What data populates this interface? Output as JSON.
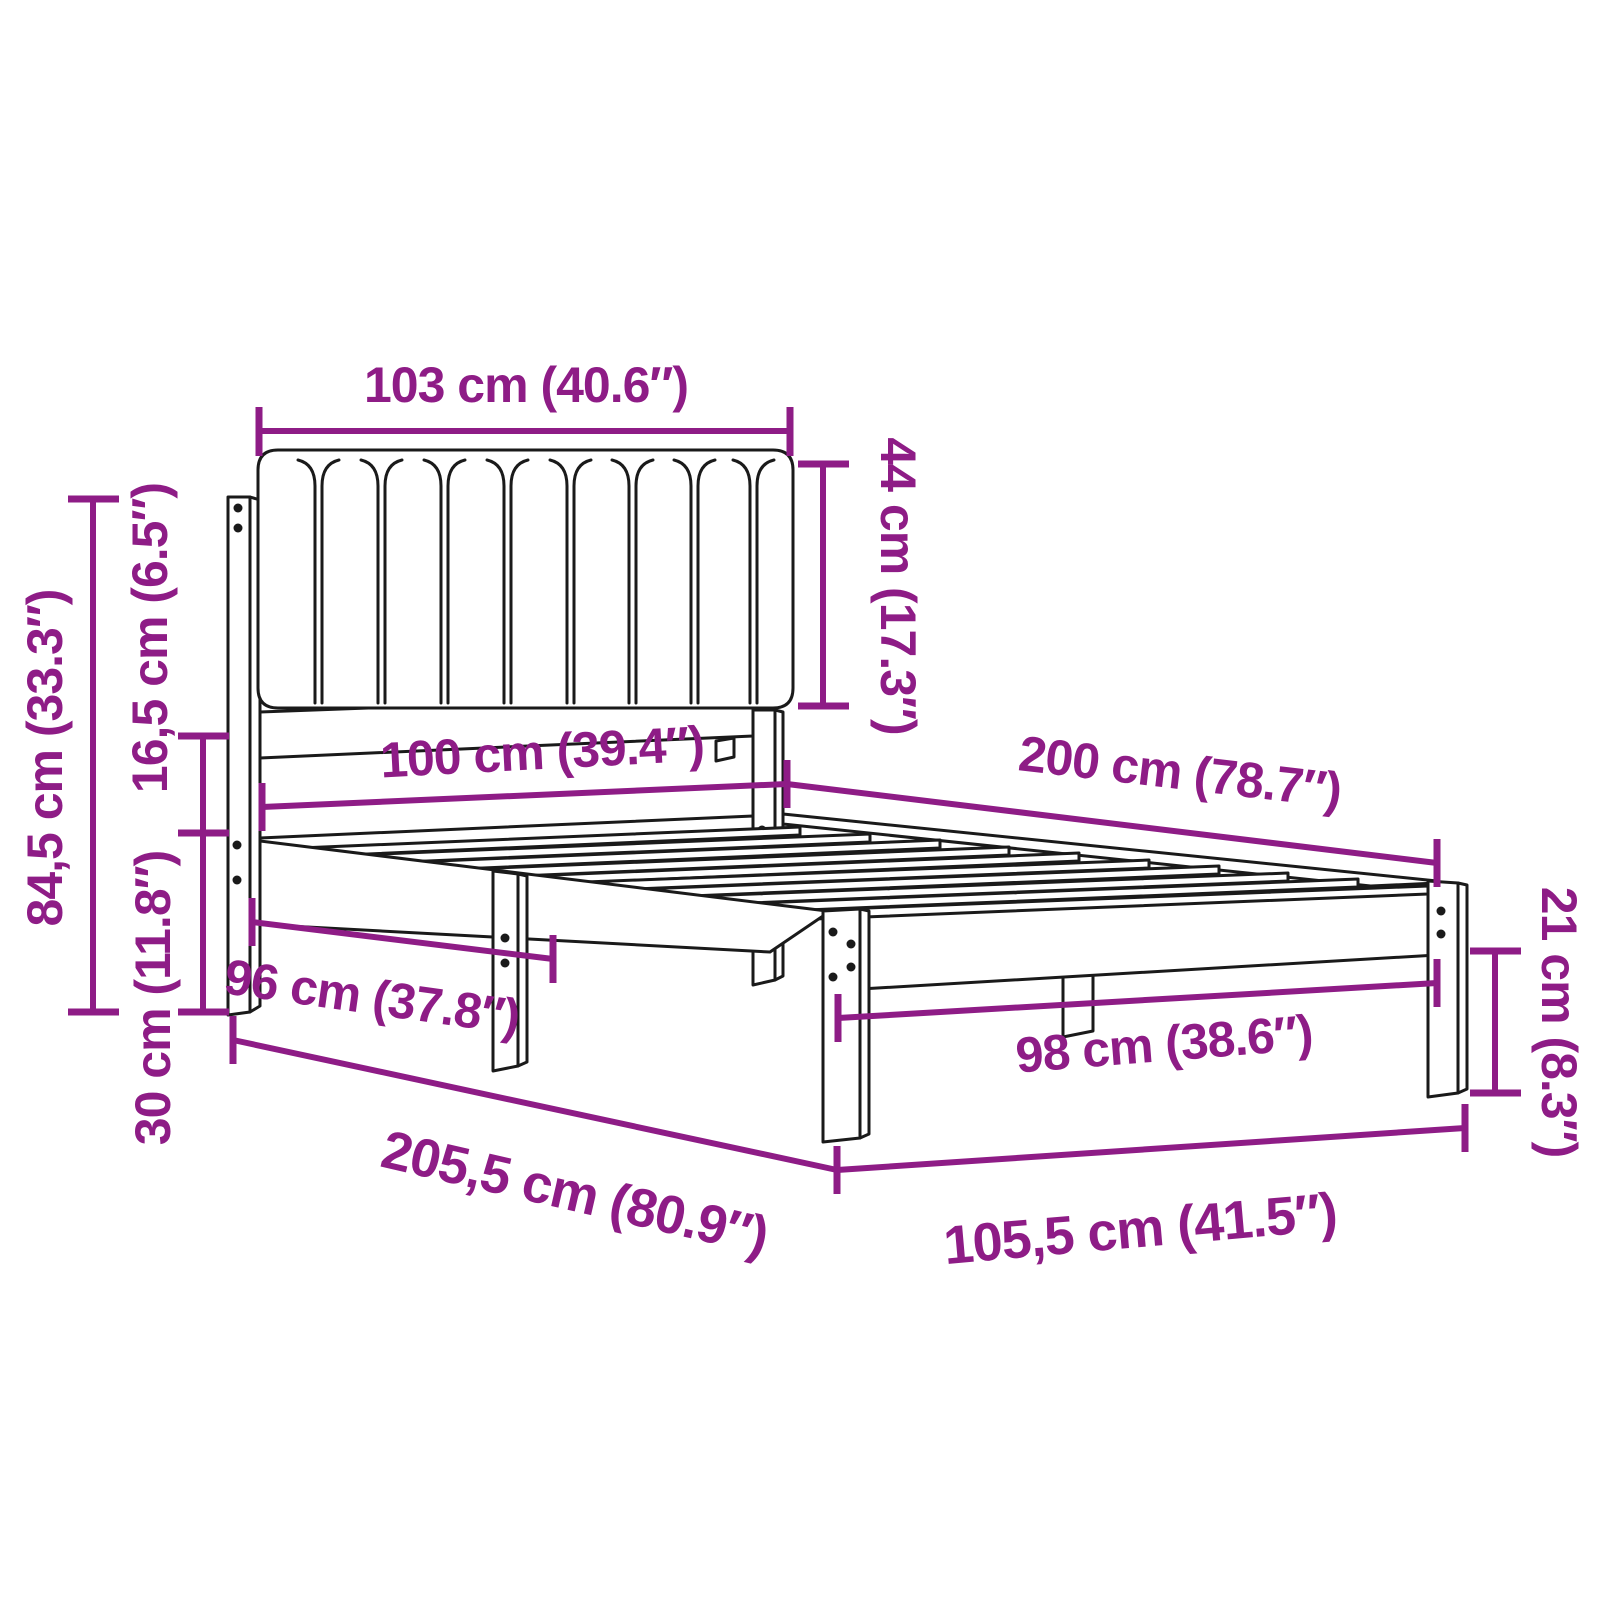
{
  "colors": {
    "accent": "#8E1C86",
    "line": "#1A1A1A",
    "background": "#FFFFFF"
  },
  "diagram": {
    "type": "product-dimension-diagram",
    "subject": "bed frame with upholstered channel-tufted headboard and slatted base",
    "units": [
      "cm",
      "inches"
    ],
    "dimensions": {
      "headboard_width": "103 cm (40.6″)",
      "headboard_cushion_height": "44 cm (17.3″)",
      "headboard_total_height": "84,5 cm (33.3″)",
      "side_rail_height": "16,5 cm (6.5″)",
      "underbed_clearance": "30 cm (11.8″)",
      "mattress_width": "100 cm (39.4″)",
      "mattress_length": "200 cm (78.7″)",
      "side_leg_clear_span": "96 cm (37.8″)",
      "foot_leg_clear_span": "98 cm (38.6″)",
      "total_length": "205,5 cm (80.9″)",
      "total_width": "105,5 cm (41.5″)",
      "foot_leg_height": "21 cm (8.3″)"
    }
  }
}
